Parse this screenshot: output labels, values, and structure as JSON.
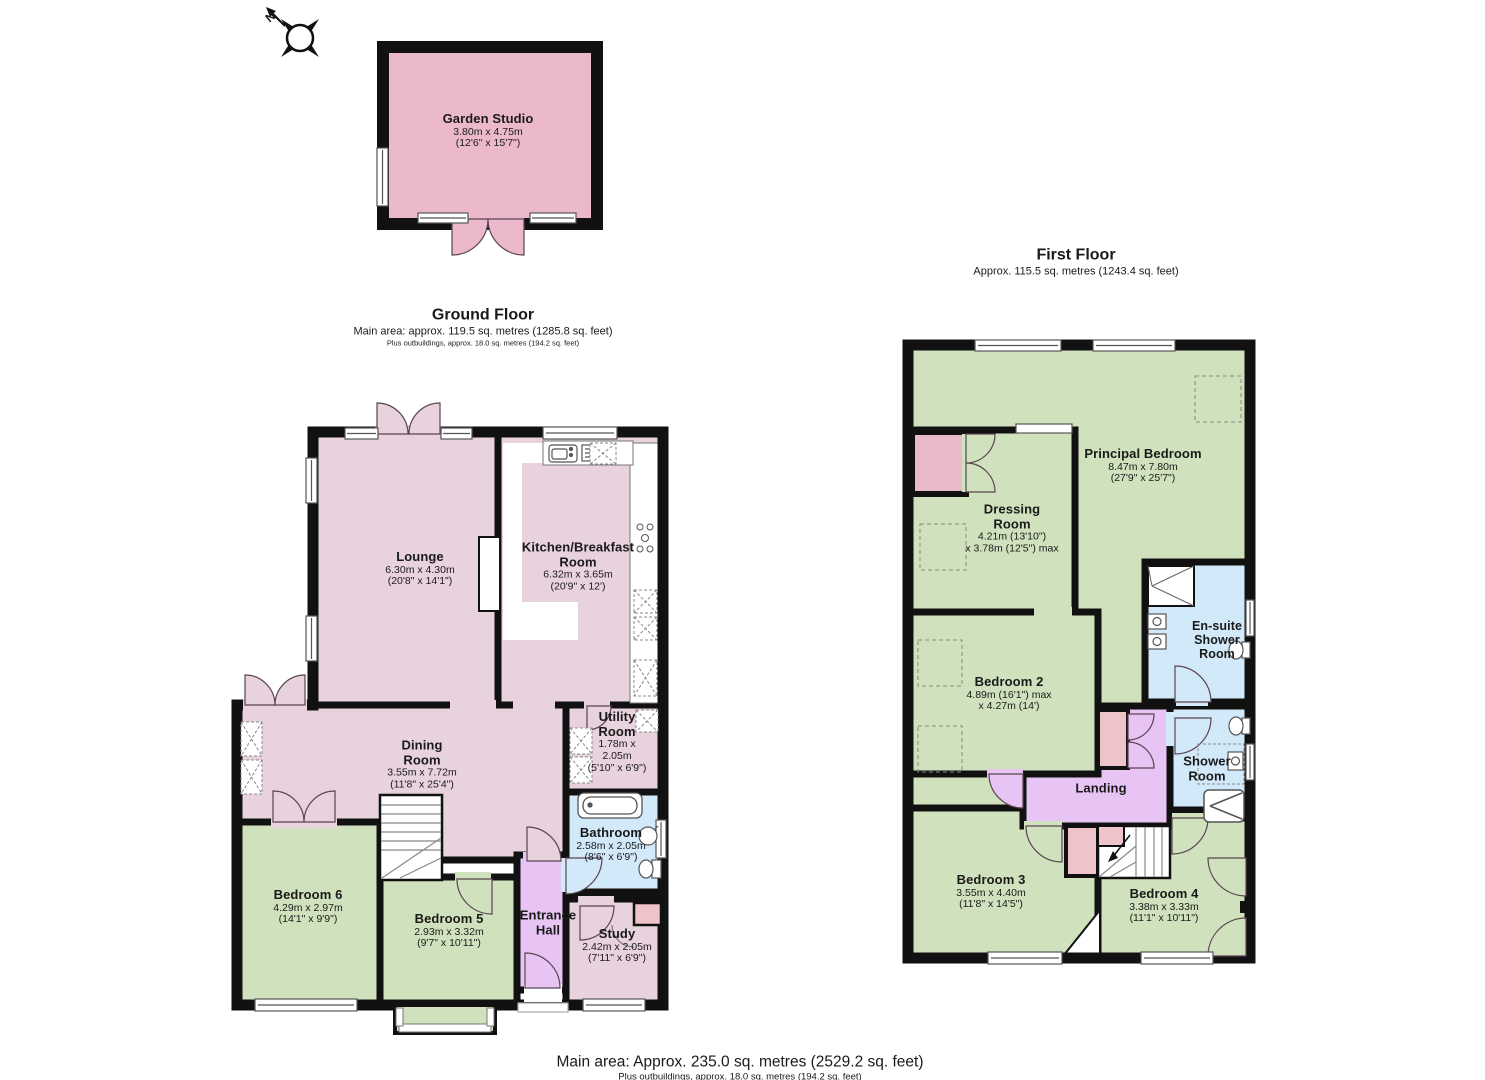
{
  "compass": {
    "north_label": "N"
  },
  "outbuilding": {
    "name": "Garden Studio",
    "dims_metric": "3.80m x 4.75m",
    "dims_imperial": "(12'6\" x 15'7\")"
  },
  "ground_floor": {
    "title": "Ground Floor",
    "area_line": "Main area: approx. 119.5 sq. metres (1285.8 sq. feet)",
    "outbuildings_line": "Plus outbuildings, approx. 18.0 sq. metres (194.2 sq. feet)",
    "rooms": [
      {
        "name": "Lounge",
        "dims_metric": "6.30m x 4.30m",
        "dims_imperial": "(20'8\" x 14'1\")"
      },
      {
        "name": "Kitchen/Breakfast Room",
        "dims_metric": "6.32m x 3.65m",
        "dims_imperial": "(20'9\" x 12')"
      },
      {
        "name": "Dining Room",
        "dims_metric": "3.55m x 7.72m",
        "dims_imperial": "(11'8\" x 25'4\")"
      },
      {
        "name": "Utility Room",
        "dims_metric": "1.78m x 2.05m",
        "dims_imperial": "(5'10\" x 6'9\")"
      },
      {
        "name": "Bathroom",
        "dims_metric": "2.58m x 2.05m",
        "dims_imperial": "(8'6\" x 6'9\")"
      },
      {
        "name": "Bedroom 6",
        "dims_metric": "4.29m x 2.97m",
        "dims_imperial": "(14'1\" x 9'9\")"
      },
      {
        "name": "Bedroom 5",
        "dims_metric": "2.93m x 3.32m",
        "dims_imperial": "(9'7\" x 10'11\")"
      },
      {
        "name": "Entrance Hall"
      },
      {
        "name": "Study",
        "dims_metric": "2.42m x 2.05m",
        "dims_imperial": "(7'11\" x 6'9\")"
      }
    ]
  },
  "first_floor": {
    "title": "First Floor",
    "area_line": "Approx. 115.5 sq. metres (1243.4 sq. feet)",
    "rooms": [
      {
        "name": "Principal Bedroom",
        "dims_metric": "8.47m x 7.80m",
        "dims_imperial": "(27'9\" x 25'7\")"
      },
      {
        "name": "Dressing Room",
        "dims_metric": "4.21m (13'10\")",
        "dims_imperial": "x 3.78m (12'5\") max"
      },
      {
        "name": "Bedroom 2",
        "dims_metric": "4.89m (16'1\") max",
        "dims_imperial": "x 4.27m (14')"
      },
      {
        "name": "En-suite Shower Room"
      },
      {
        "name": "Shower Room"
      },
      {
        "name": "Landing"
      },
      {
        "name": "Bedroom 3",
        "dims_metric": "3.55m x 4.40m",
        "dims_imperial": "(11'8\" x 14'5\")"
      },
      {
        "name": "Bedroom 4",
        "dims_metric": "3.38m x 3.33m",
        "dims_imperial": "(11'1\" x 10'11\")"
      }
    ]
  },
  "footer": {
    "area_line": "Main area: Approx. 235.0 sq. metres (2529.2 sq. feet)",
    "outbuildings_line": "Plus outbuildings, approx. 18.0 sq. metres (194.2 sq. feet)"
  },
  "colors": {
    "wall": "#111111",
    "room_pink": "#e7d2dd",
    "accent_pink": "#ecb9cc",
    "salmon_pink": "#eec3c9",
    "bedroom_green": "#cfe2bd",
    "bath_blue": "#d2e9fa",
    "hall_lilac": "#e7c4f4"
  }
}
